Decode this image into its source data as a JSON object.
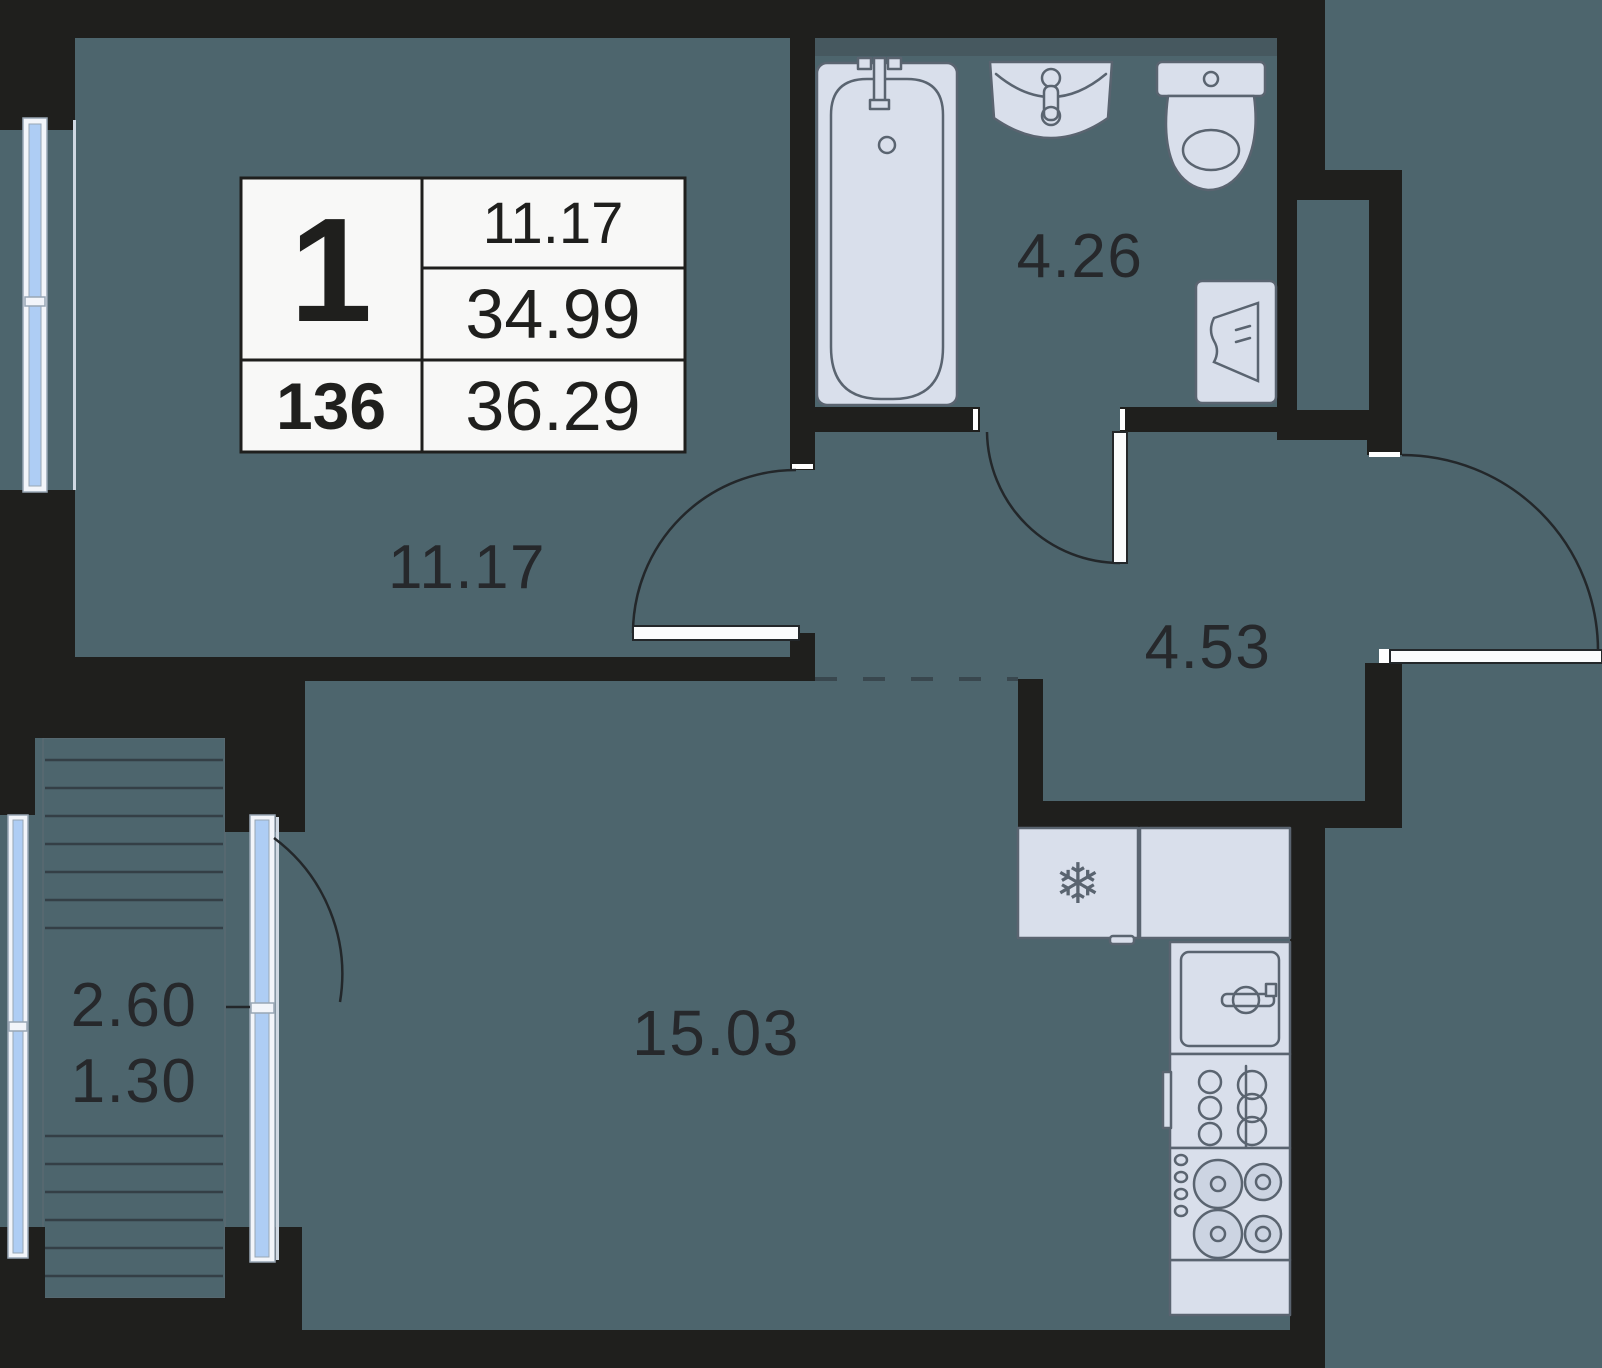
{
  "legend": {
    "rooms_count": "1",
    "unit_number": "136",
    "living_area": "11.17",
    "area_without_balcony": "34.99",
    "total_area": "36.29"
  },
  "room_labels": {
    "bedroom": "11.17",
    "bathroom": "4.26",
    "hallway": "4.53",
    "kitchen_living": "15.03",
    "balcony_full": "2.60",
    "balcony_reduced": "1.30"
  },
  "icons": {
    "fridge_snowflake": "❄"
  },
  "colors": {
    "background": "#4d656d",
    "wall": "#1f1f1d",
    "fixture_fill": "#d9dfeb",
    "fixture_stroke": "#5a6470",
    "glazing": "#aecdf4",
    "window_frame": "#f2f5fa",
    "table_background": "#f8f8f7",
    "label_text": "#26282b",
    "dashed_line": "#39474e",
    "deck_line": "#343f46"
  }
}
